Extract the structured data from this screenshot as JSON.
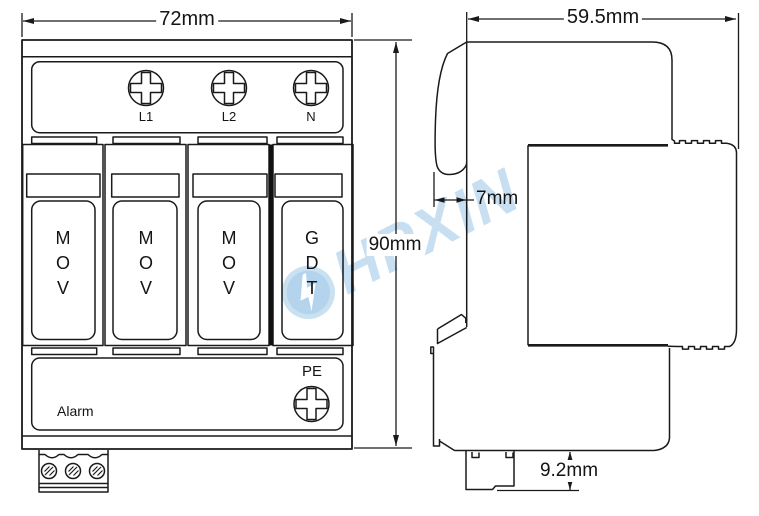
{
  "front_view": {
    "width_label": "72mm",
    "height_label": "90mm",
    "terminal_labels": [
      "L1",
      "L2",
      "N"
    ],
    "module_labels": [
      "MOV",
      "MOV",
      "MOV",
      "GDT"
    ],
    "pe_label": "PE",
    "alarm_label": "Alarm"
  },
  "side_view": {
    "width_label": "59.5mm",
    "din_lip_label": "7mm",
    "rail_depth_label": "9.2mm"
  },
  "watermark": {
    "text": "HPXIN",
    "color": "#a6cce9",
    "icon_fill": "#85b9e2",
    "ring_color": "#a9cfe9"
  }
}
